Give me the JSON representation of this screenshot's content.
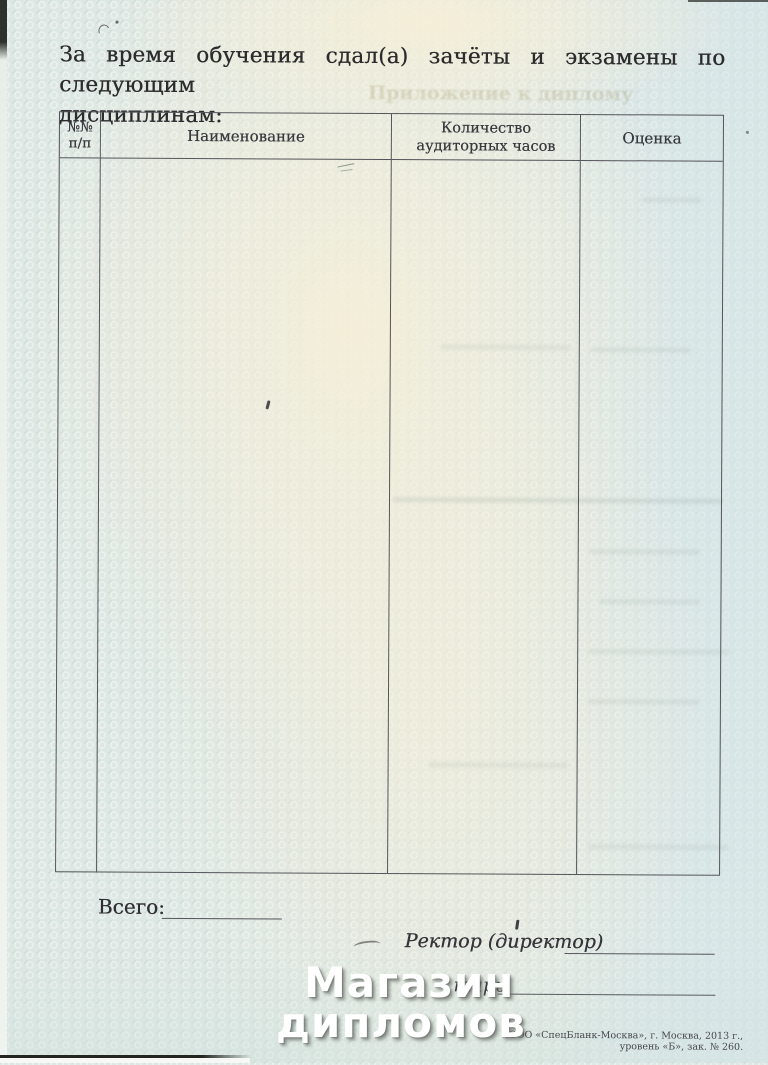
{
  "document": {
    "title_line1": "За время обучения сдал(а) зачёты и экзамены по следующим",
    "title_line2": "дисциплинам:"
  },
  "table": {
    "columns": [
      {
        "line1": "№№",
        "line2": "п/п"
      },
      {
        "line1": "Наименование",
        "line2": ""
      },
      {
        "line1": "Количество",
        "line2": "аудиторных часов"
      },
      {
        "line1": "Оценка",
        "line2": ""
      }
    ],
    "rows": []
  },
  "footer": {
    "total_label": "Всего:",
    "rector_label": "Ректор (директор)",
    "secretary_label_visible": "тарь",
    "imprint": "ООО «СпецБланк-Москва», г. Москва, 2013 г., уровень «Б», зак. № 260."
  },
  "watermark": {
    "line1": "Магазин",
    "line2": "дипломов"
  },
  "ghost": {
    "bleed_text": "Приложение к диплому"
  },
  "colors": {
    "paper": "#dde7e3",
    "paper_cream": "#f6efd8",
    "ink": "#2e2e31",
    "table_border": "#54555a",
    "watermark": "#ffffff"
  }
}
